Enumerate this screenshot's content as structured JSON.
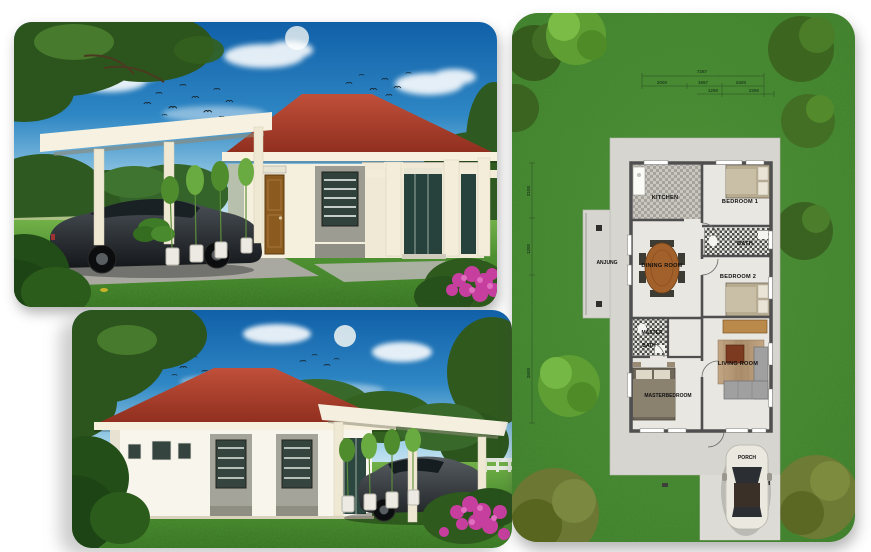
{
  "plan": {
    "room_labels": {
      "kitchen": "KITCHEN",
      "bedroom1": "BEDROOM 1",
      "bath": "BATH",
      "anjung": "ANJUNG",
      "dining": "DINING ROOM",
      "bedroom2": "BEDROOM 2",
      "master_bath_1": "MASTER",
      "master_bath_2": "BATH",
      "living": "LIVING ROOM",
      "master_bedroom": "MASTERBEDROOM",
      "porch": "PORCH"
    },
    "dimensions": {
      "total": "7267",
      "row1": [
        "2000",
        "1667",
        "2400"
      ],
      "row2": [
        "1250",
        "2350"
      ],
      "left": [
        "2100",
        "1200",
        "2600"
      ]
    }
  },
  "colors": {
    "sky_top": "#1060a8",
    "sky_horizon": "#d8eef7",
    "roof_red": "#a63b28",
    "wall_cream": "#f5efdd",
    "accent_gray": "#9c9c92",
    "door_brown": "#8a5a1e",
    "lawn_green": "#4c8f2b",
    "plan_grass": "#47862d",
    "concrete": "#d6d5cf",
    "plan_wall": "#4a4a4a",
    "wood": "#a2602a",
    "sofa_gray": "#a0a0a0",
    "car_dark": "#33383c",
    "car_white": "#ece9e0",
    "flower_magenta": "#c63f9f"
  }
}
